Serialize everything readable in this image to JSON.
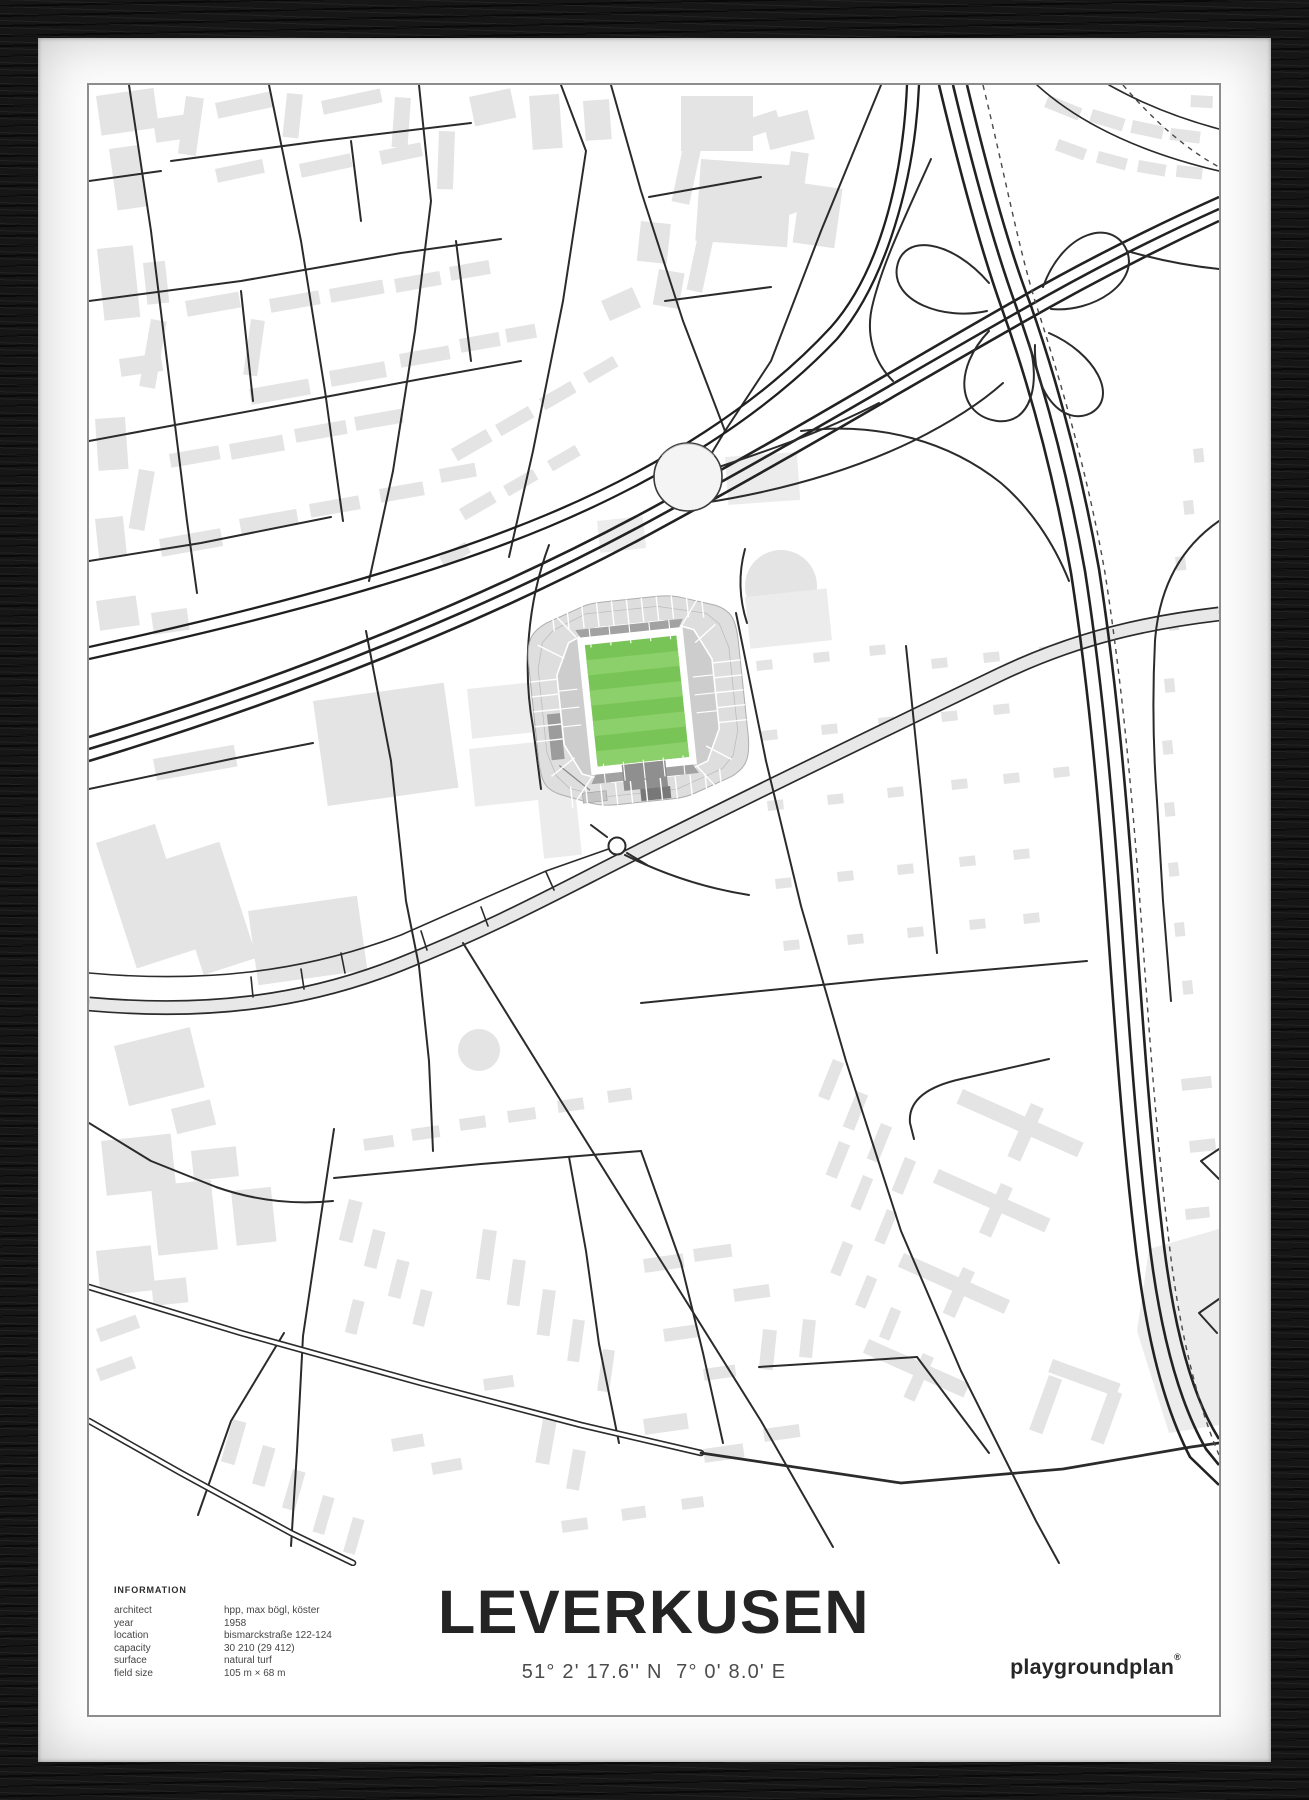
{
  "poster": {
    "title": "LEVERKUSEN",
    "coordinates": "51° 2' 17.6'' N  7° 0' 8.0' E",
    "brand": "playgroundplan",
    "brand_mark": "®",
    "info": {
      "header": "INFORMATION",
      "rows": [
        {
          "label": "architect",
          "value": "hpp, max bögl, köster"
        },
        {
          "label": "year",
          "value": "1958"
        },
        {
          "label": "location",
          "value": "bismarckstraße 122-124"
        },
        {
          "label": "capacity",
          "value": "30 210 (29 412)"
        },
        {
          "label": "surface",
          "value": "natural turf"
        },
        {
          "label": "field size",
          "value": "105 m × 68 m"
        }
      ]
    }
  },
  "colors": {
    "pitch_green": "#79c457",
    "pitch_stripe": "#8bd06a",
    "building_gray": "#e4e4e4",
    "road_dark": "#2b2b2b",
    "stand_light": "#dedede",
    "stand_dark": "#a2a2a2",
    "frame_black": "#161616"
  }
}
